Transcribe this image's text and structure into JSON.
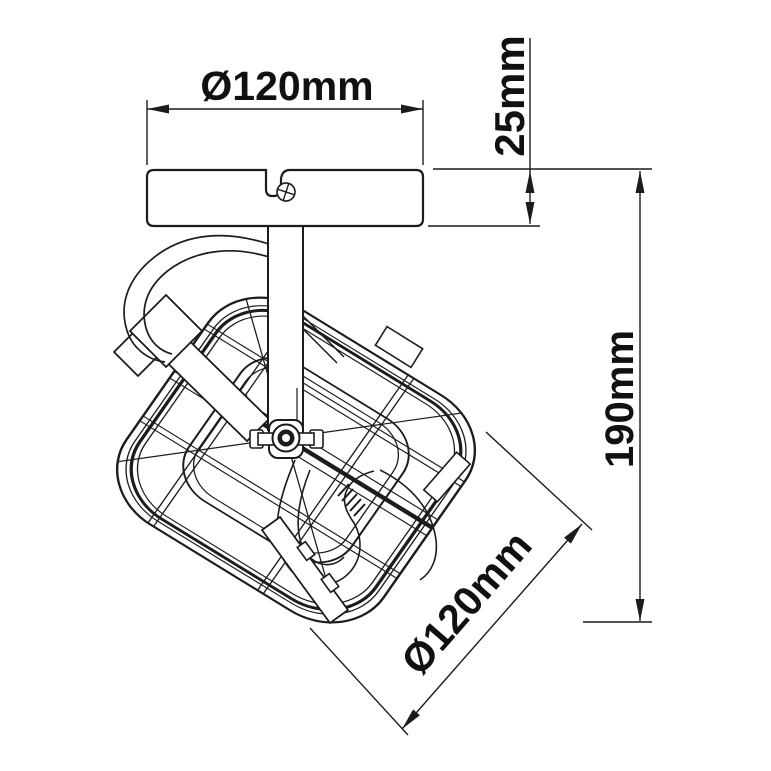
{
  "diagram": {
    "type": "technical-dimension-drawing",
    "subject": "ceiling spotlight fixture",
    "background_color": "#ffffff",
    "line_color": "#1c1c1c",
    "dimensions": {
      "canopy_diameter_label": "Ø120mm",
      "canopy_height_label": "25mm",
      "overall_height_label": "190mm",
      "head_diameter_label": "Ø120mm"
    },
    "parts": [
      "ceiling-canopy",
      "mounting-screw",
      "stem",
      "power-cable",
      "yoke-bracket",
      "pivot-wing-nut",
      "lamp-head-wire-guard",
      "bulb"
    ]
  }
}
